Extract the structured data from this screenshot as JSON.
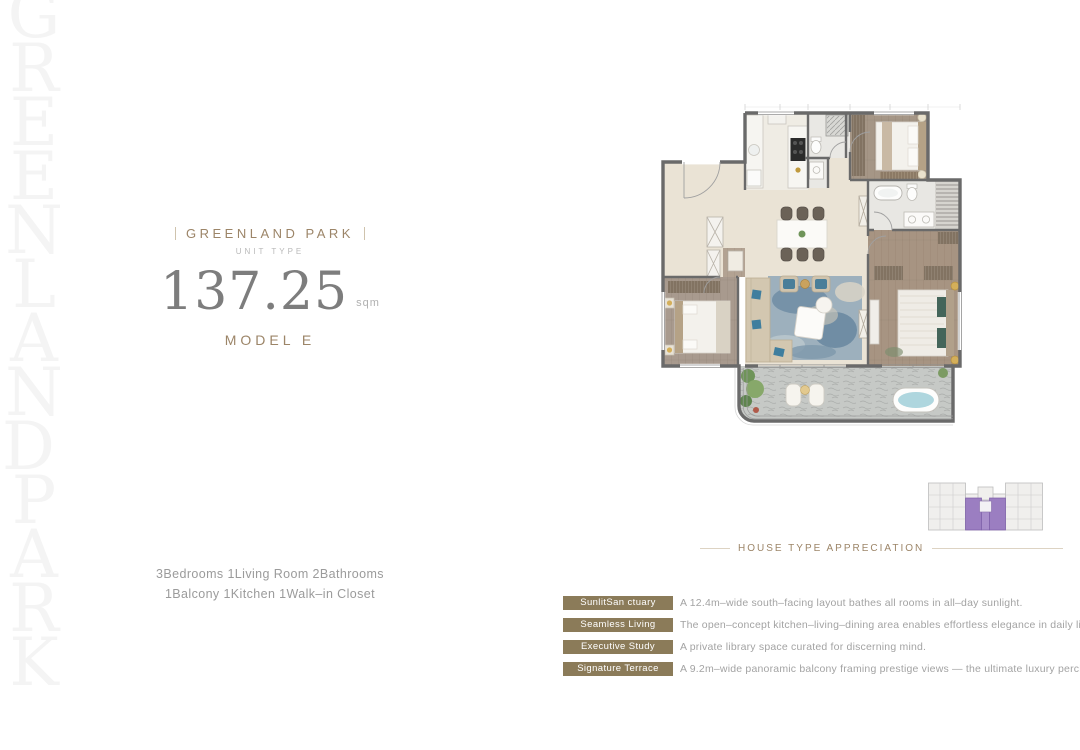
{
  "watermark": {
    "text": "GREENLAND PARK"
  },
  "title_block": {
    "brand": "GREENLAND PARK",
    "subtitle": "UNIT TYPE",
    "area_value": "137.25",
    "area_unit": "sqm",
    "model": "MODEL E"
  },
  "unit_summary": {
    "line1": "3Bedrooms 1Living Room 2Bathrooms",
    "line2": "1Balcony 1Kitchen 1Walk–in Closet"
  },
  "key_plan": {
    "caption": "HOUSE TYPE APPRECIATION",
    "highlight_color": "#9b7ec1"
  },
  "features": [
    {
      "tag": "SunlitSan ctuary",
      "desc": "A 12.4m–wide south–facing layout bathes all rooms in all–day sunlight."
    },
    {
      "tag": "Seamless Living",
      "desc": "The open–concept kitchen–living–dining area enables effortless elegance in daily life."
    },
    {
      "tag": "Executive Study",
      "desc": "A private library space curated for discerning mind."
    },
    {
      "tag": "Signature Terrace",
      "desc": "A 9.2m–wide panoramic balcony framing prestige views — the ultimate luxury perch."
    }
  ],
  "colors": {
    "accent": "#9c8568",
    "tag_background": "#8b7b59",
    "body_gray": "#9b9b9b",
    "number_gray": "#7d7d7d",
    "watermark_gray": "#f4f4f4",
    "wall_gray": "#6a6a6a",
    "floor_beige": "#eae3d5",
    "balcony_stone": "#c6c9c6",
    "key_plan_highlight": "#9b7ec1"
  }
}
